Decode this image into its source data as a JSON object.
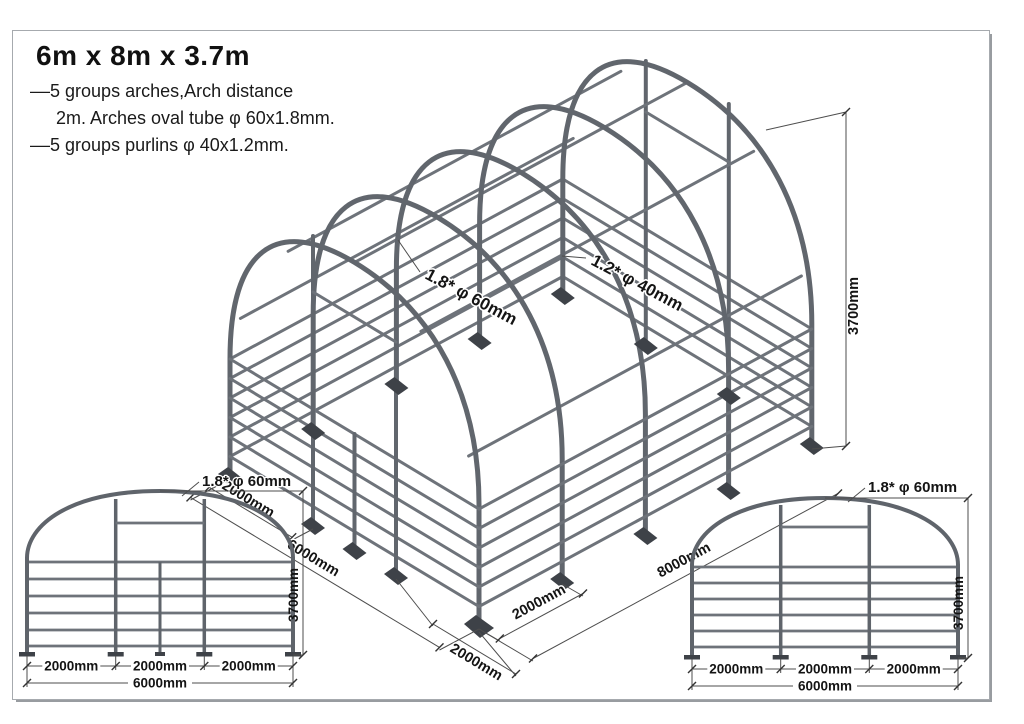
{
  "title": "6m x 8m x 3.7m",
  "notes": [
    "––5 groups arches,Arch distance",
    "2m. Arches oval tube  φ 60x1.8mm.",
    "––5 groups purlins  φ 40x1.2mm."
  ],
  "iso": {
    "bay": "2000mm",
    "width": "6000mm",
    "gate": "2000mm",
    "length_bay": "2000mm",
    "length": "8000mm",
    "height": "3700mm",
    "arch_label": "1.8* φ 60mm",
    "purlin_label": "1.2* φ 40mm"
  },
  "front_view": {
    "arch_label": "1.8* φ 60mm",
    "height": "3700mm",
    "bays": [
      "2000mm",
      "2000mm",
      "2000mm"
    ],
    "total": "6000mm"
  },
  "rear_view": {
    "arch_label": "1.8* φ 60mm",
    "height": "3700mm",
    "bays": [
      "2000mm",
      "2000mm",
      "2000mm"
    ],
    "total": "6000mm"
  }
}
